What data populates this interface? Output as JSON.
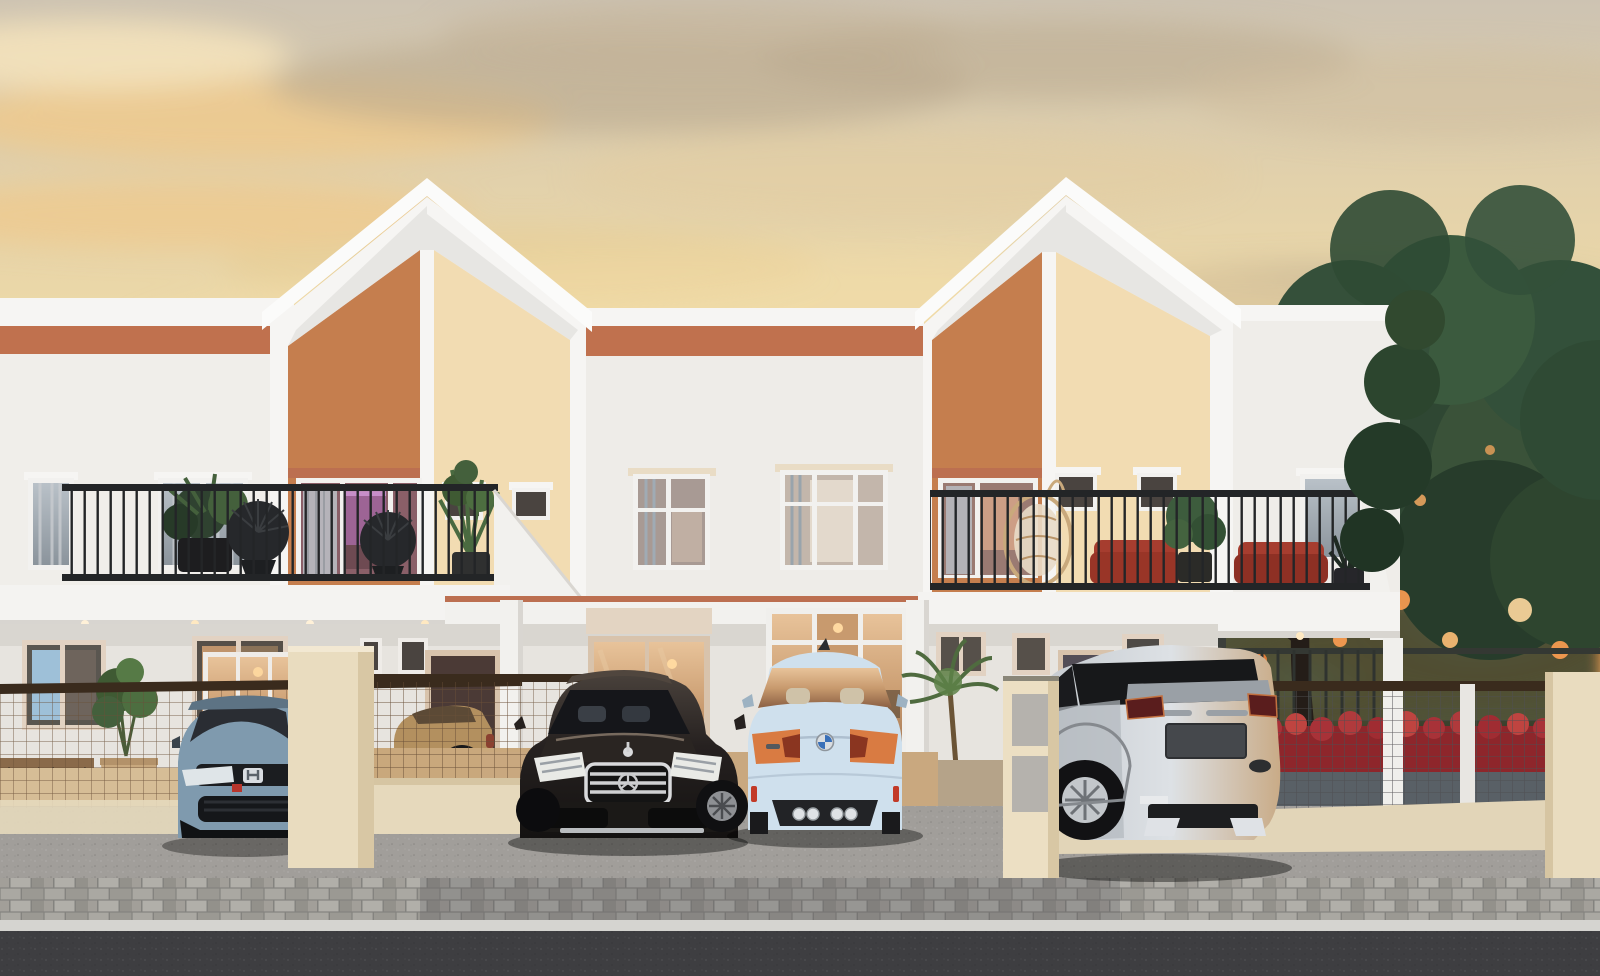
{
  "scene": {
    "type": "architectural-rendering",
    "time_of_day": "sunset",
    "subject": "Row of modern two-story terraced houses with peaked gable accent facades, balconies with black railings and plants, carports with four luxury cars, paved driveway and street in front, large tree with sunset glow at right"
  },
  "palette": {
    "sky_top": "#cdc3b2",
    "sky_high": "#e2d1ab",
    "sky_mid": "#f0dba6",
    "sky_warm": "#f6e3ae",
    "sky_low": "#f3d795",
    "cloud_gold": "#f0c98a",
    "cloud_gray": "#b9a98e",
    "cloud_cream": "#f7e6bd",
    "wall_white": "#f0eeea",
    "wall_shadow": "#e7e4df",
    "trim_white": "#f6f5f3",
    "fascia_orange": "#c0714e",
    "gable_orange": "#c57e4e",
    "gable_cream": "#f2dcb2",
    "salmon_strip": "#bc6f50",
    "beige_wall": "#e9dcbf",
    "beige_shade": "#d6c5a2",
    "railing_dark": "#232527",
    "mesh_brown": "#6a5038",
    "mesh_gray": "#4f4f51",
    "rail_brown": "#3a2b1d",
    "glass_dark": "#232528",
    "interior_warm": "#c89a6e",
    "interior_pink": "#b06ac2",
    "door_brown": "#4b3a36",
    "door_gray": "#534e57",
    "driveway_gray": "#a19e9a",
    "carport_floor": "#c9a87f",
    "sand_floor": "#d6bd96",
    "paver_gray": "#9a9a96",
    "curb_light": "#d5d4d0",
    "asphalt_dark": "#3e3e41",
    "tree_dark": "#2c4331",
    "tree_mid": "#3a5239",
    "tree_light": "#5d7f52",
    "sunset_glow": "#ff9a45",
    "sunset_core": "#ffd9a0",
    "hedge_red": "#a83238"
  },
  "cars": {
    "honda_civic": {
      "label": "light blue hatchback, front view, far left",
      "body": "#7f9aae",
      "glass": "#2a2d33"
    },
    "sedan": {
      "label": "tan sedan behind side fence",
      "body": "#b3905f"
    },
    "mercedes_s_class": {
      "label": "black luxury sedan, front view, center left",
      "body": "#262120",
      "grille": "#cfd0d2"
    },
    "bmw_m4": {
      "label": "pale blue coupe, rear view, center right",
      "body": "#cfe0ed",
      "taillight": "#d97b42"
    },
    "range_rover_evoque": {
      "label": "silver compact SUV, rear view, right",
      "body": "#d2d6da",
      "glass_band": "#17181a"
    }
  },
  "buildings": {
    "left_flat": {
      "wall": "white",
      "band": "terracotta",
      "upper_windows": 2
    },
    "left_gable": {
      "panel_left": "orange",
      "panel_right": "cream",
      "balcony": "black railing, dark plants, two wicker fan chairs, pink-lit glass door"
    },
    "middle_flat": {
      "wall": "white",
      "band": "terracotta",
      "upper_windows": 2
    },
    "right_gable": {
      "panel_left": "orange",
      "panel_right": "cream",
      "balcony": "black railing, hanging egg chair, red cushion sofas, plants"
    },
    "right_flat": {
      "wall": "white"
    }
  },
  "ground": {
    "front": "gray concrete driveway",
    "band": "cobblestone paver strip",
    "curb": "light curb",
    "street": "dark asphalt"
  }
}
